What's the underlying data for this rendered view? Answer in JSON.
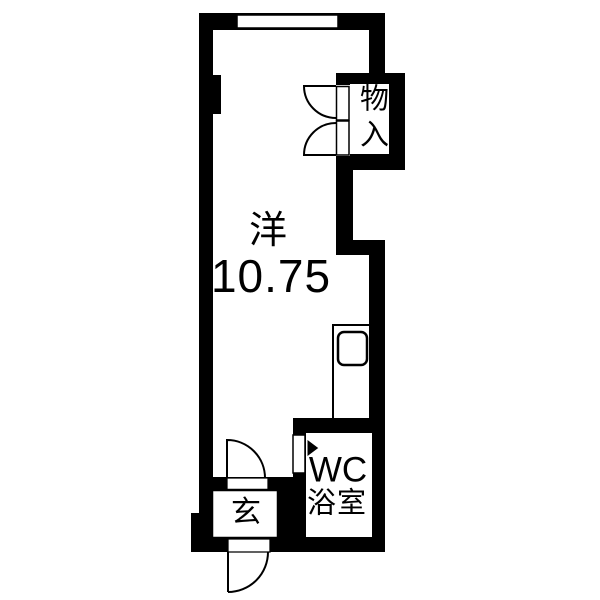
{
  "plan": {
    "type": "floor-plan",
    "colors": {
      "wall": "#000000",
      "floor": "#ffffff",
      "line": "#000000"
    },
    "rooms": {
      "main": {
        "name_label": "洋",
        "size_label": "10.75"
      },
      "closet": {
        "label": "物入"
      },
      "bathroom": {
        "wc_label": "WC",
        "bath_label": "浴室"
      },
      "entrance": {
        "label": "玄"
      }
    }
  }
}
